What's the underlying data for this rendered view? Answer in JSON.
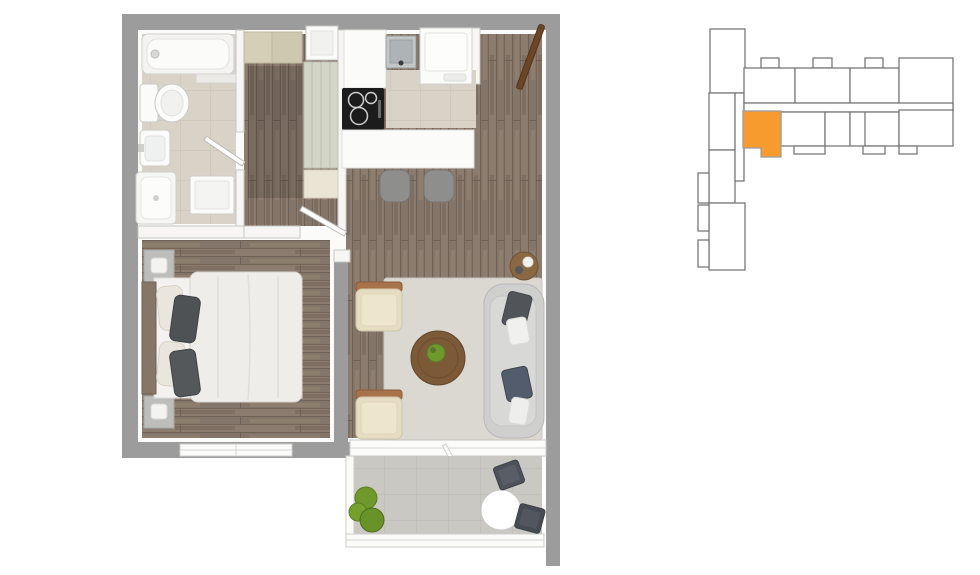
{
  "scene": {
    "kind": "apartment-floor-plan-with-building-key-plan",
    "floor_plan_rooms": [
      "bathroom",
      "hallway",
      "kitchen",
      "living-room",
      "bedroom",
      "balcony"
    ],
    "key_plan_highlighted_unit": "selected-apartment"
  },
  "colors": {
    "background": "#ffffff",
    "wall_exterior": "#9c9c9c",
    "wall_interior": "#f7f6f4",
    "wood_floor": "#8c7c6f",
    "wood_floor_dark": "#75665a",
    "tile_bathroom": "#d9d3c7",
    "tile_balcony": "#cac8c2",
    "rug": "#dad8d0",
    "sofa": "#cfcfcd",
    "armchair": "#e6dcc2",
    "armchair_wood": "#a8724a",
    "coffee_table": "#7c5a38",
    "side_table": "#8a6842",
    "bed_duvet": "#efede9",
    "headboard": "#857668",
    "pillow_dark": "#515458",
    "plant_green": "#6f9a2b",
    "patio_chair": "#4e525a",
    "entrance_door": "#6b4526",
    "cooktop_black": "#1c1c1c",
    "stool_gray": "#8e8e8c",
    "fixture_white": "#fbfbfa",
    "keyplan_fill": "#ffffff",
    "keyplan_stroke": "#6f6f6f",
    "highlight": "#F89B2F"
  }
}
